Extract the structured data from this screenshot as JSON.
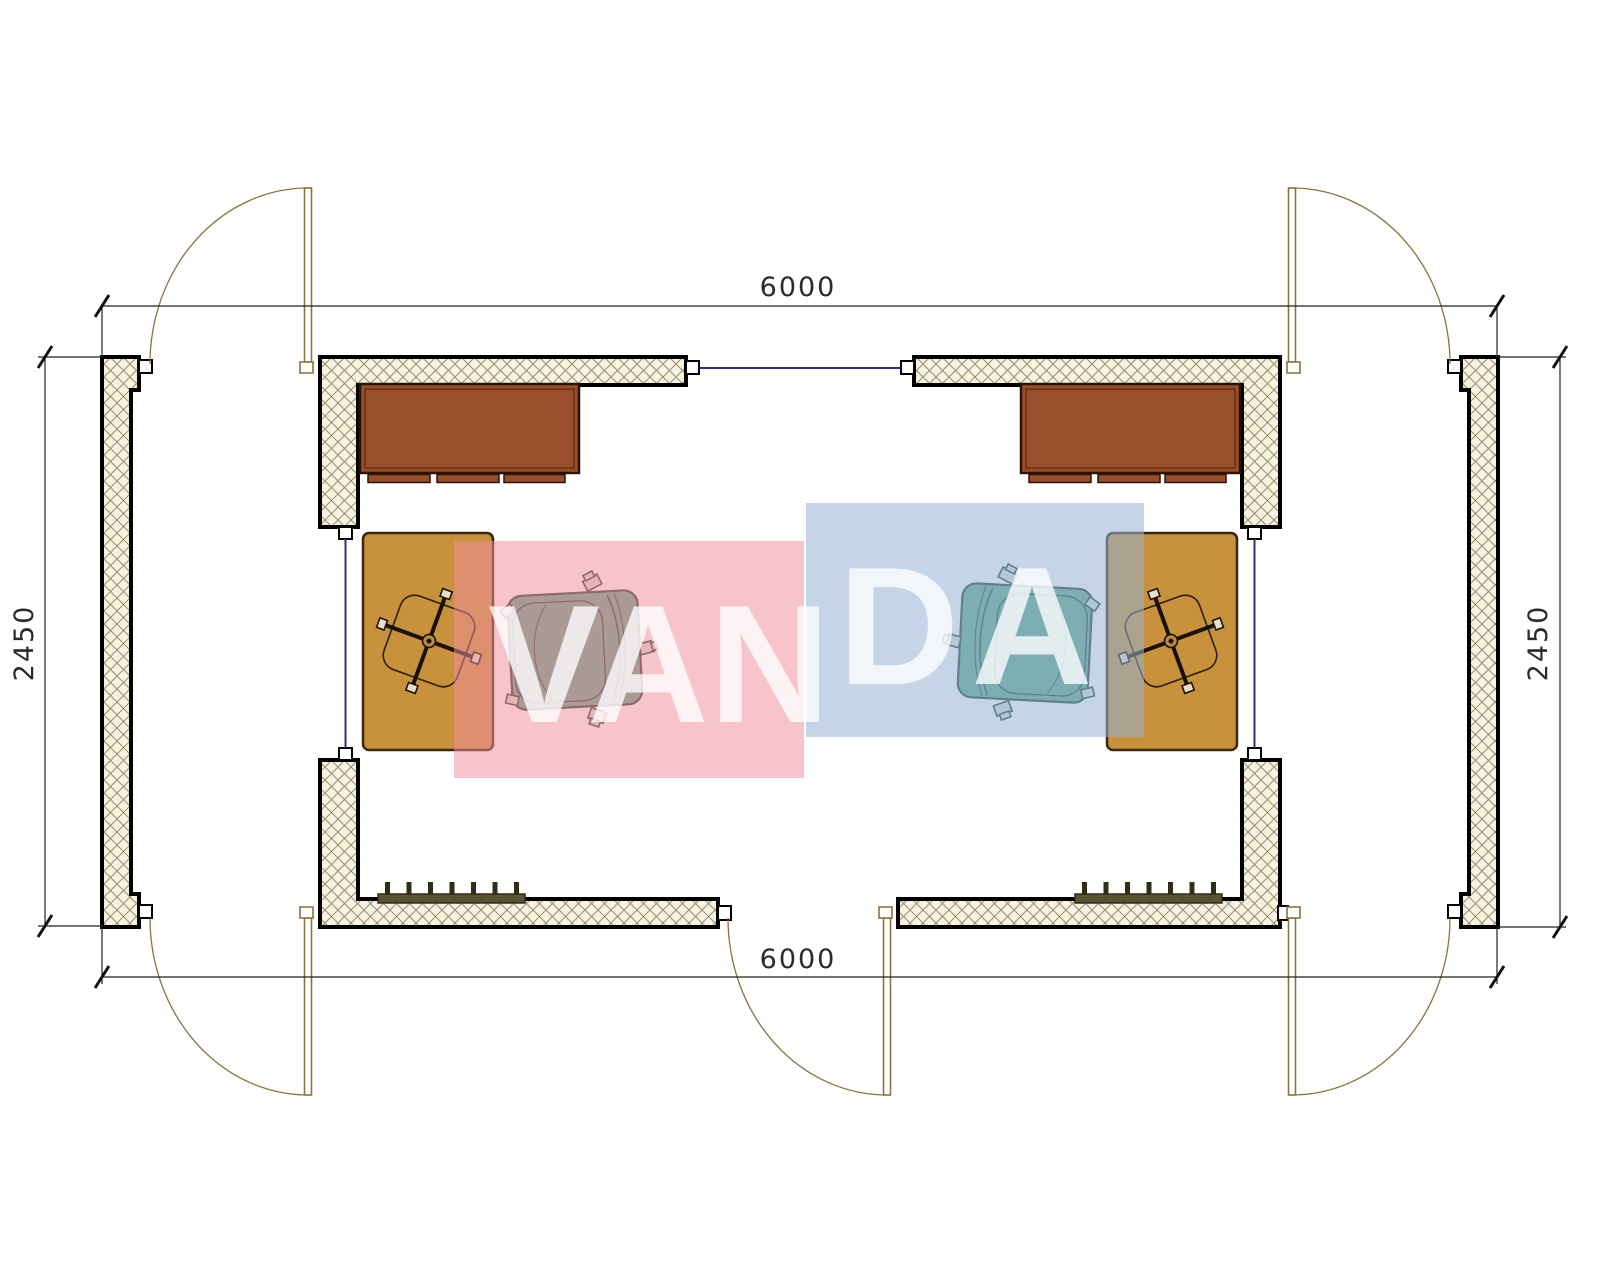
{
  "watermark": {
    "text": "VANDA",
    "part_1": "VAN",
    "part_2": "DA",
    "pink_block_color": "#F7C6CE",
    "blue_block_color": "#C9D6E8"
  },
  "dimensions": {
    "unit": "mm",
    "top": {
      "label": "6000"
    },
    "bottom": {
      "label": "6000"
    },
    "left": {
      "label": "2450"
    },
    "right": {
      "label": "2450"
    }
  },
  "plan": {
    "overall_width_mm": 6000,
    "overall_depth_mm": 2450,
    "wall_fill": "crosshatch",
    "door_count": 5,
    "window_count": 3,
    "rooms": [
      {
        "name": "left module",
        "furniture": [
          "desk with drawers",
          "desk swivel chair",
          "side table",
          "armchair",
          "radiator"
        ]
      },
      {
        "name": "right module",
        "furniture": [
          "desk with drawers",
          "desk swivel chair",
          "side table",
          "armchair",
          "radiator"
        ]
      }
    ]
  },
  "colors": {
    "wall_hatch_line": "#9A8D68",
    "wall_hatch_bg": "#F7F3E3",
    "wall_border": "#000000",
    "door_swing": "#8A7340",
    "window_line": "#2B2E83",
    "desk_brown": "#9A4F2B",
    "table_tan": "#C8913B",
    "armchair_teal": "#5FA98E",
    "radiator_olive": "#5B5234",
    "dimension_line": "#222222"
  }
}
